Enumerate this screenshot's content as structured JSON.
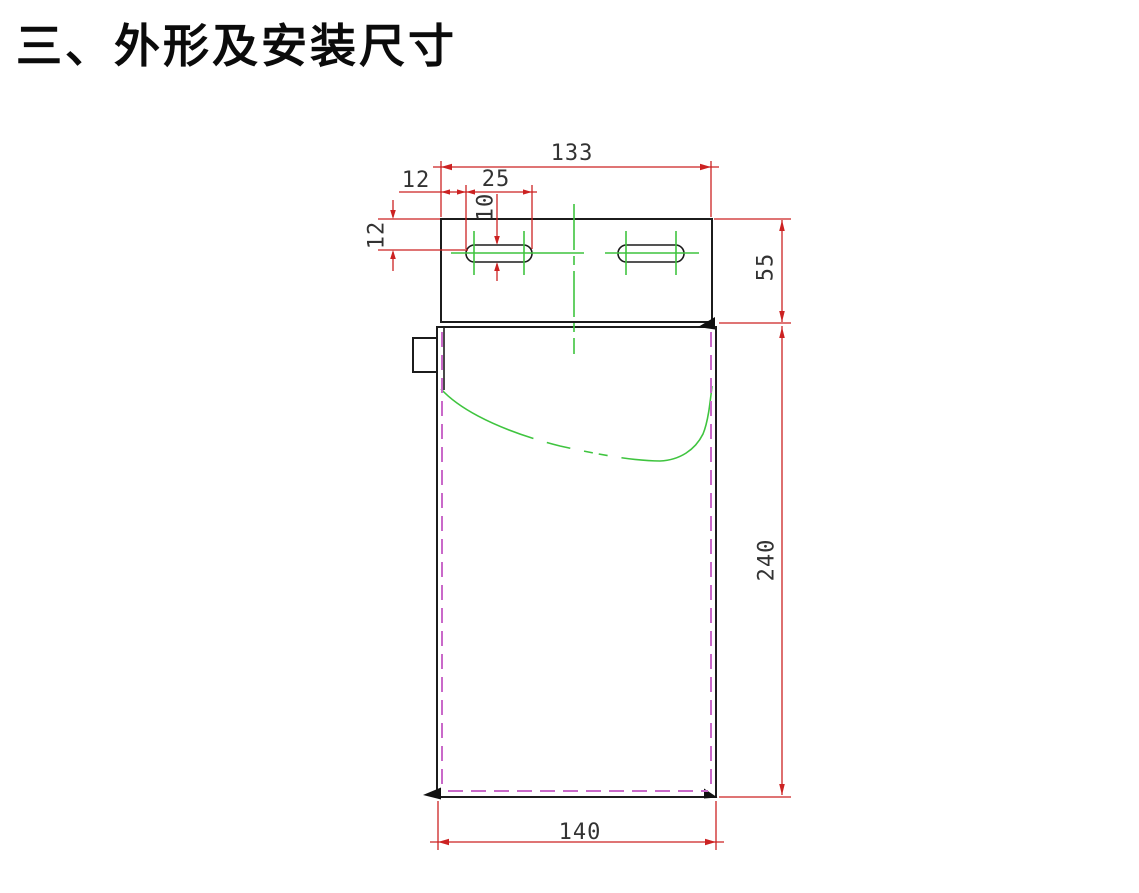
{
  "page": {
    "title": "三、外形及安装尺寸"
  },
  "drawing": {
    "dimensions": {
      "bracket_width": "133",
      "slot_edge_offset": "12",
      "slot_length": "25",
      "slot_width": "10",
      "slot_center_offset": "12",
      "bracket_height": "55",
      "body_height": "240",
      "body_width": "140"
    },
    "colors": {
      "outline": "#1c1c1c",
      "dimension": "#cc2222",
      "centerline": "#3fc43f",
      "hidden_line": "#c969c9"
    }
  }
}
